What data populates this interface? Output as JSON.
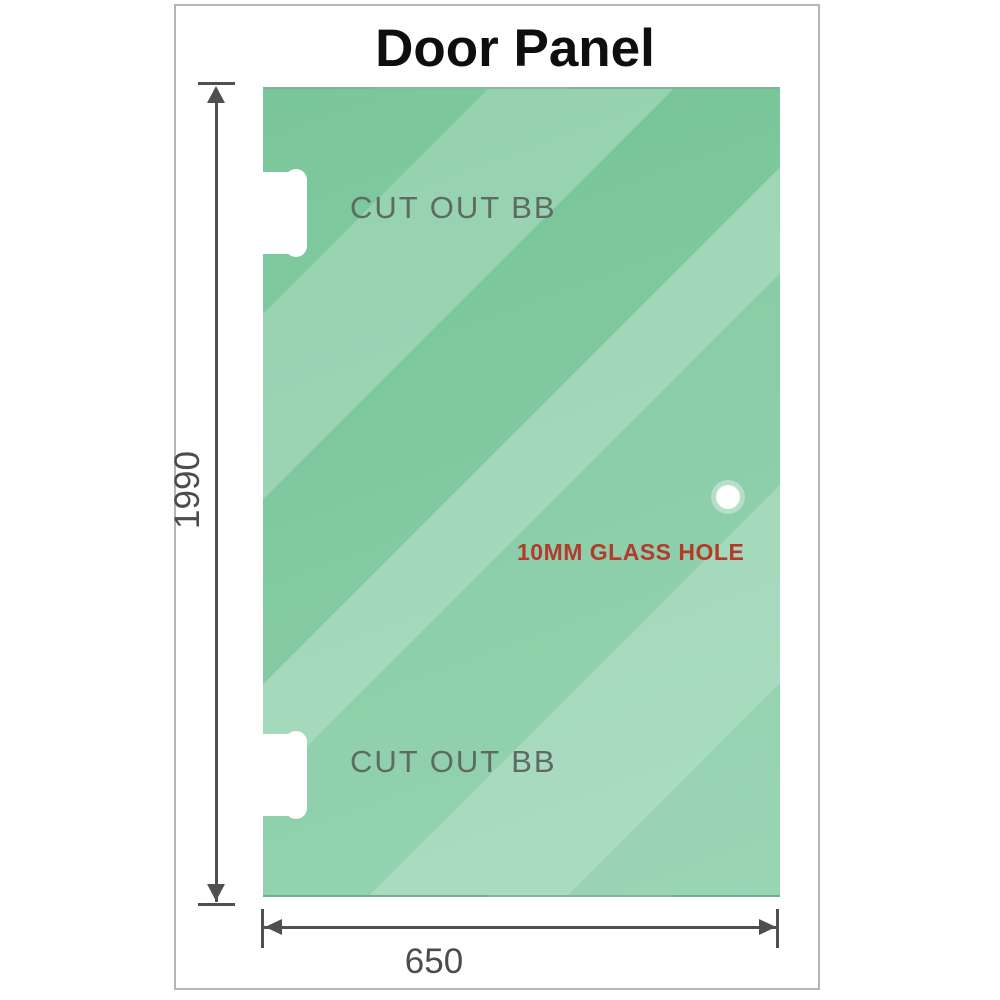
{
  "title": "Door Panel",
  "panel": {
    "cutout_top": {
      "label": "CUT OUT BB"
    },
    "cutout_bottom": {
      "label": "CUT OUT BB"
    },
    "glass_hole": {
      "label": "10MM GLASS HOLE"
    }
  },
  "dimensions": {
    "height_mm": "1990",
    "width_mm": "650"
  },
  "colors": {
    "glass_green": "#7cc79d",
    "glass_highlight": "#a5d9bd",
    "dimension_line": "#4f4f4f",
    "cutout_label_gray": "#5d6b63",
    "hole_label_red": "#b43a2c",
    "page_border_gray": "#b5b5b5"
  }
}
